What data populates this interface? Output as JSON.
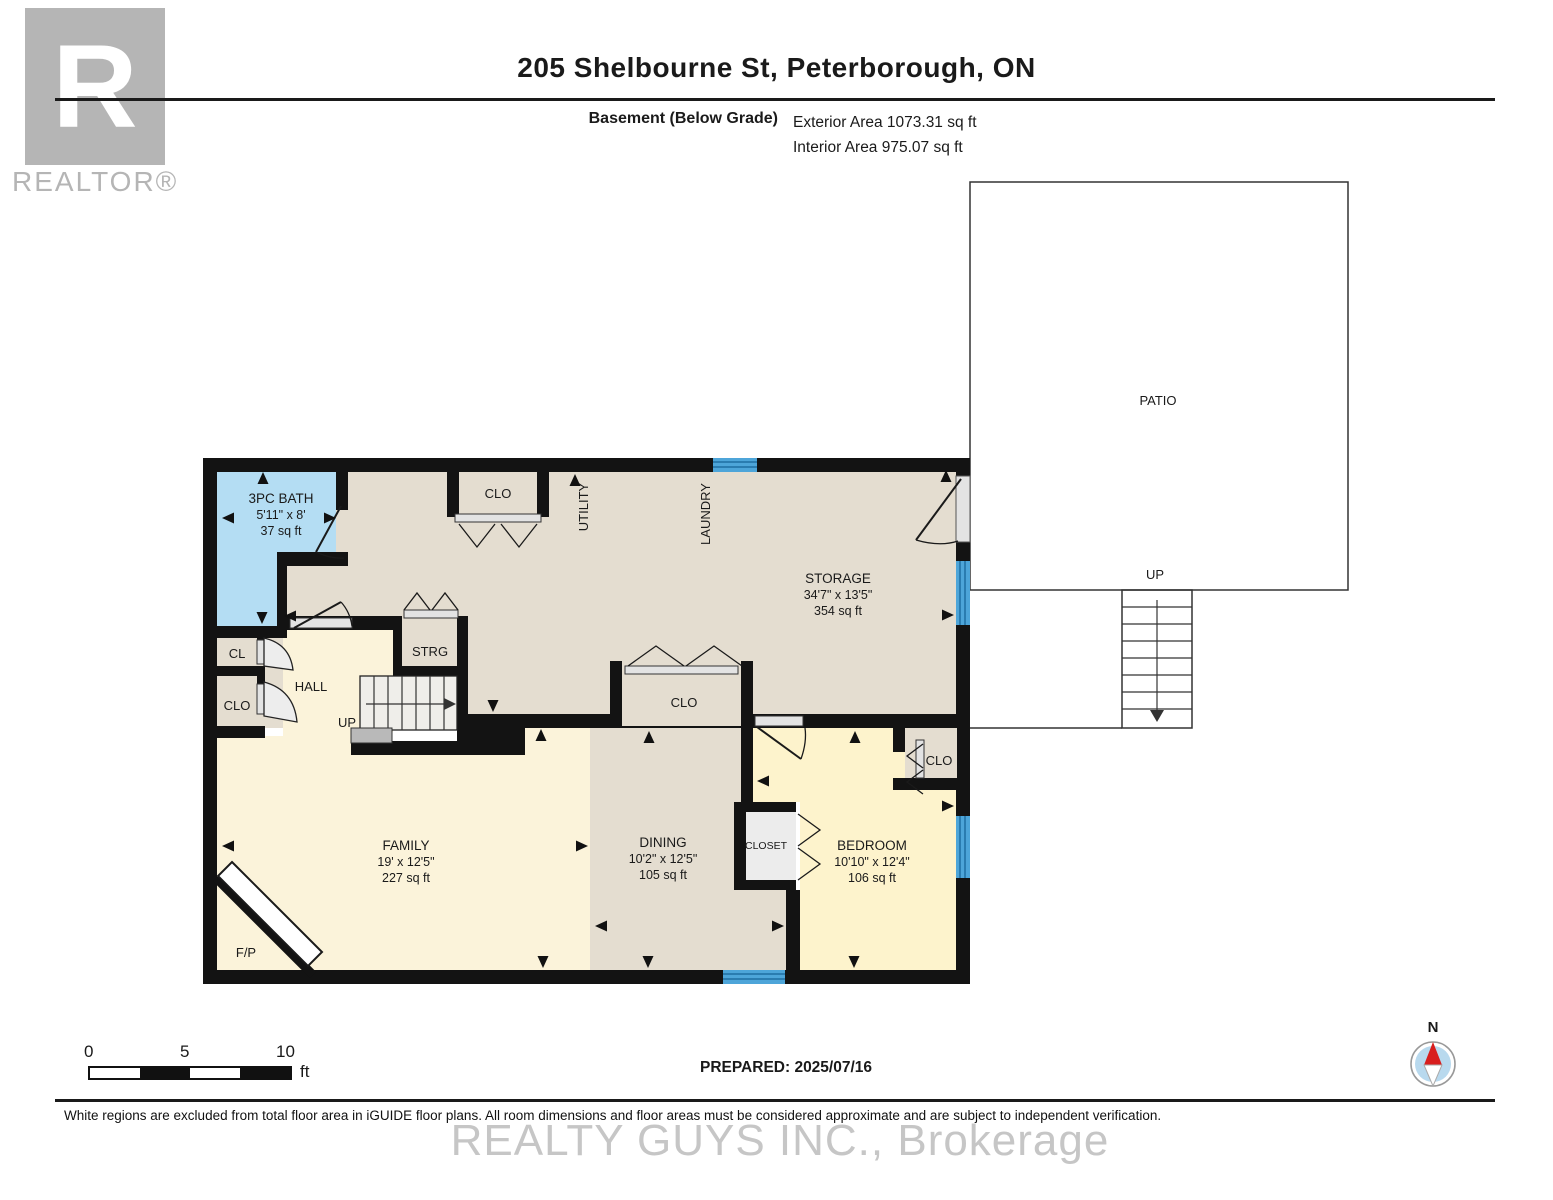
{
  "header": {
    "title": "205 Shelbourne St, Peterborough, ON",
    "floor_label": "Basement (Below Grade)",
    "exterior_area": "Exterior Area 1073.31 sq ft",
    "interior_area": "Interior Area 975.07 sq ft"
  },
  "logo": {
    "letter": "R",
    "text": "REALTOR®"
  },
  "plan": {
    "rooms": {
      "bath": {
        "name": "3PC BATH",
        "dims": "5'11\" x 8'",
        "area": "37 sq ft"
      },
      "storage": {
        "name": "STORAGE",
        "dims": "34'7\" x 13'5\"",
        "area": "354 sq ft"
      },
      "family": {
        "name": "FAMILY",
        "dims": "19' x 12'5\"",
        "area": "227 sq ft"
      },
      "dining": {
        "name": "DINING",
        "dims": "10'2\" x 12'5\"",
        "area": "105 sq ft"
      },
      "bedroom": {
        "name": "BEDROOM",
        "dims": "10'10\" x 12'4\"",
        "area": "106 sq ft"
      }
    },
    "labels": {
      "clo": "CLO",
      "cl": "CL",
      "hall": "HALL",
      "strg": "STRG",
      "up": "UP",
      "utility": "UTILITY",
      "laundry": "LAUNDRY",
      "closet": "CLOSET",
      "fp": "F/P",
      "patio": "PATIO"
    }
  },
  "scale": {
    "tick0": "0",
    "tick5": "5",
    "tick10": "10",
    "unit": "ft"
  },
  "prepared": "PREPARED: 2025/07/16",
  "compass": {
    "north": "N"
  },
  "disclaimer": "White regions are excluded from total floor area in iGUIDE floor plans. All room dimensions and floor areas must be considered approximate and are subject to independent verification.",
  "watermark": "REALTY GUYS INC., Brokerage",
  "colors": {
    "wall": "#131313",
    "storage_floor": "#e4ddd0",
    "living_floor": "#fbf3da",
    "bedroom_floor": "#fdf3cc",
    "bath_floor": "#b4ddf3",
    "closet_interior": "#ececec",
    "window": "#4da5d9",
    "window_stripe": "#1e6fa3",
    "door": "#e3e3e3",
    "stair_landing": "#b9b9b9",
    "compass_red": "#d81e1e",
    "compass_blue": "#b8d9ee",
    "logo_gray": "#b5b5b5"
  }
}
